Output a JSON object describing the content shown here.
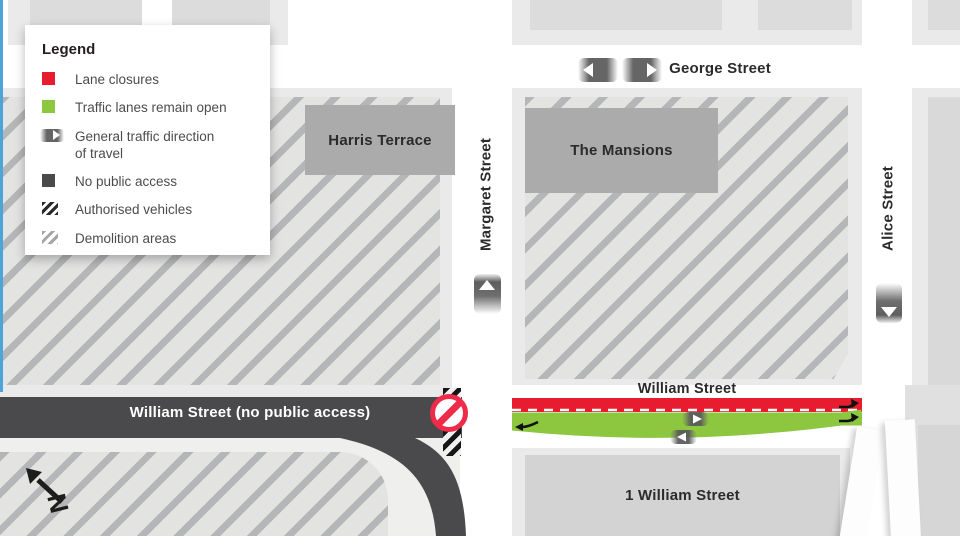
{
  "legend": {
    "title": "Legend",
    "items": [
      {
        "id": "lane-closures",
        "label": "Lane closures",
        "color": "#e81c2f"
      },
      {
        "id": "lanes-open",
        "label": "Traffic lanes remain open",
        "color": "#8dc63f"
      },
      {
        "id": "traffic-direction",
        "label": "General traffic direction of travel"
      },
      {
        "id": "no-public-access",
        "label": "No public access",
        "color": "#4a4a4c"
      },
      {
        "id": "authorised-vehicles",
        "label": "Authorised vehicles"
      },
      {
        "id": "demolition-areas",
        "label": "Demolition areas"
      }
    ]
  },
  "streets": {
    "george": {
      "label": "George Street"
    },
    "margaret": {
      "label": "Margaret Street"
    },
    "alice": {
      "label": "Alice Street"
    },
    "william_open": {
      "label": "William Street"
    },
    "william_closed": {
      "label": "William Street (no public access)"
    }
  },
  "buildings": {
    "harris_terrace": {
      "label": "Harris Terrace"
    },
    "mansions": {
      "label": "The Mansions"
    },
    "one_william": {
      "label": "1 William Street"
    }
  },
  "compass": {
    "label": "N"
  },
  "colors": {
    "lane_closure_red": "#e81c2f",
    "lane_open_green": "#8dc63f",
    "no_access_dark": "#4a4a4c",
    "building_gray": "#ababab",
    "hatch_stripe": "#b5b6b7",
    "edge_blue": "#4ba5d8"
  }
}
